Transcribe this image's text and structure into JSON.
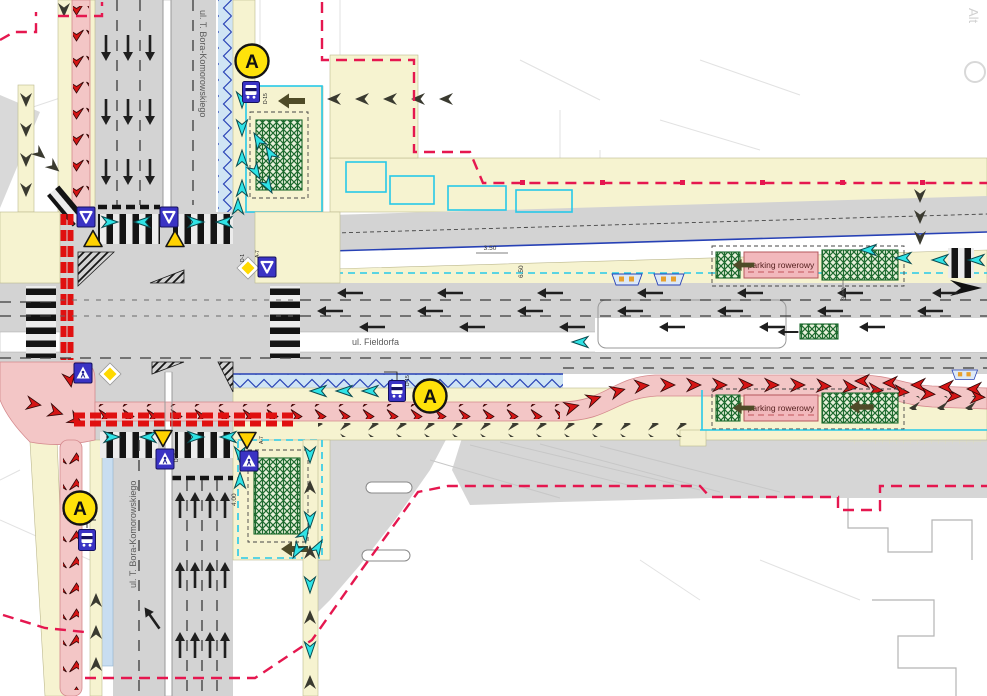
{
  "title": "traffic-organization-plan",
  "streets": {
    "fieldorfa": "ul. Fieldorfa",
    "bora_komorowskiego": "ul. T. Bora-Komorowskiego"
  },
  "labels": {
    "bike_parking": "parking rowerowy",
    "bus_stop_marker": "A",
    "watermark": "Alt"
  },
  "dimensions": {
    "d350": "3.50",
    "d650": "6.50",
    "d300": "3.00",
    "d400": "4.00"
  },
  "sign_codes": {
    "d1": "D-1",
    "a7": "A-7",
    "d6b": "D-6b",
    "d15": "D-15"
  },
  "colors": {
    "road": "#d3d3d3",
    "road2": "#dcdcdc",
    "lot": "#d6d6d6",
    "sidewalk": "#f6f3d0",
    "sidewalkEdge": "#bdb98f",
    "bikePink": "#f3c6c6",
    "parkingPink": "#f2b8bc",
    "bikeChevron": "#d41414",
    "crossingRed": "#e01010",
    "cyan": "#2fe3e6",
    "cyanLine": "#27c9e8",
    "navy": "#2741b5",
    "zigzagBg": "#cfe4f4",
    "busLaneBlue": "#c8ddf0",
    "boundary": "#e5174f",
    "signBlue": "#3a33c4",
    "signYellow": "#ffd900",
    "greenDark": "#1d6a2e",
    "olive": "#4f4b28",
    "darkChevron": "#3a3a30",
    "parcel": "#e2e2e2",
    "watermarkGray": "#d0d0d0"
  }
}
